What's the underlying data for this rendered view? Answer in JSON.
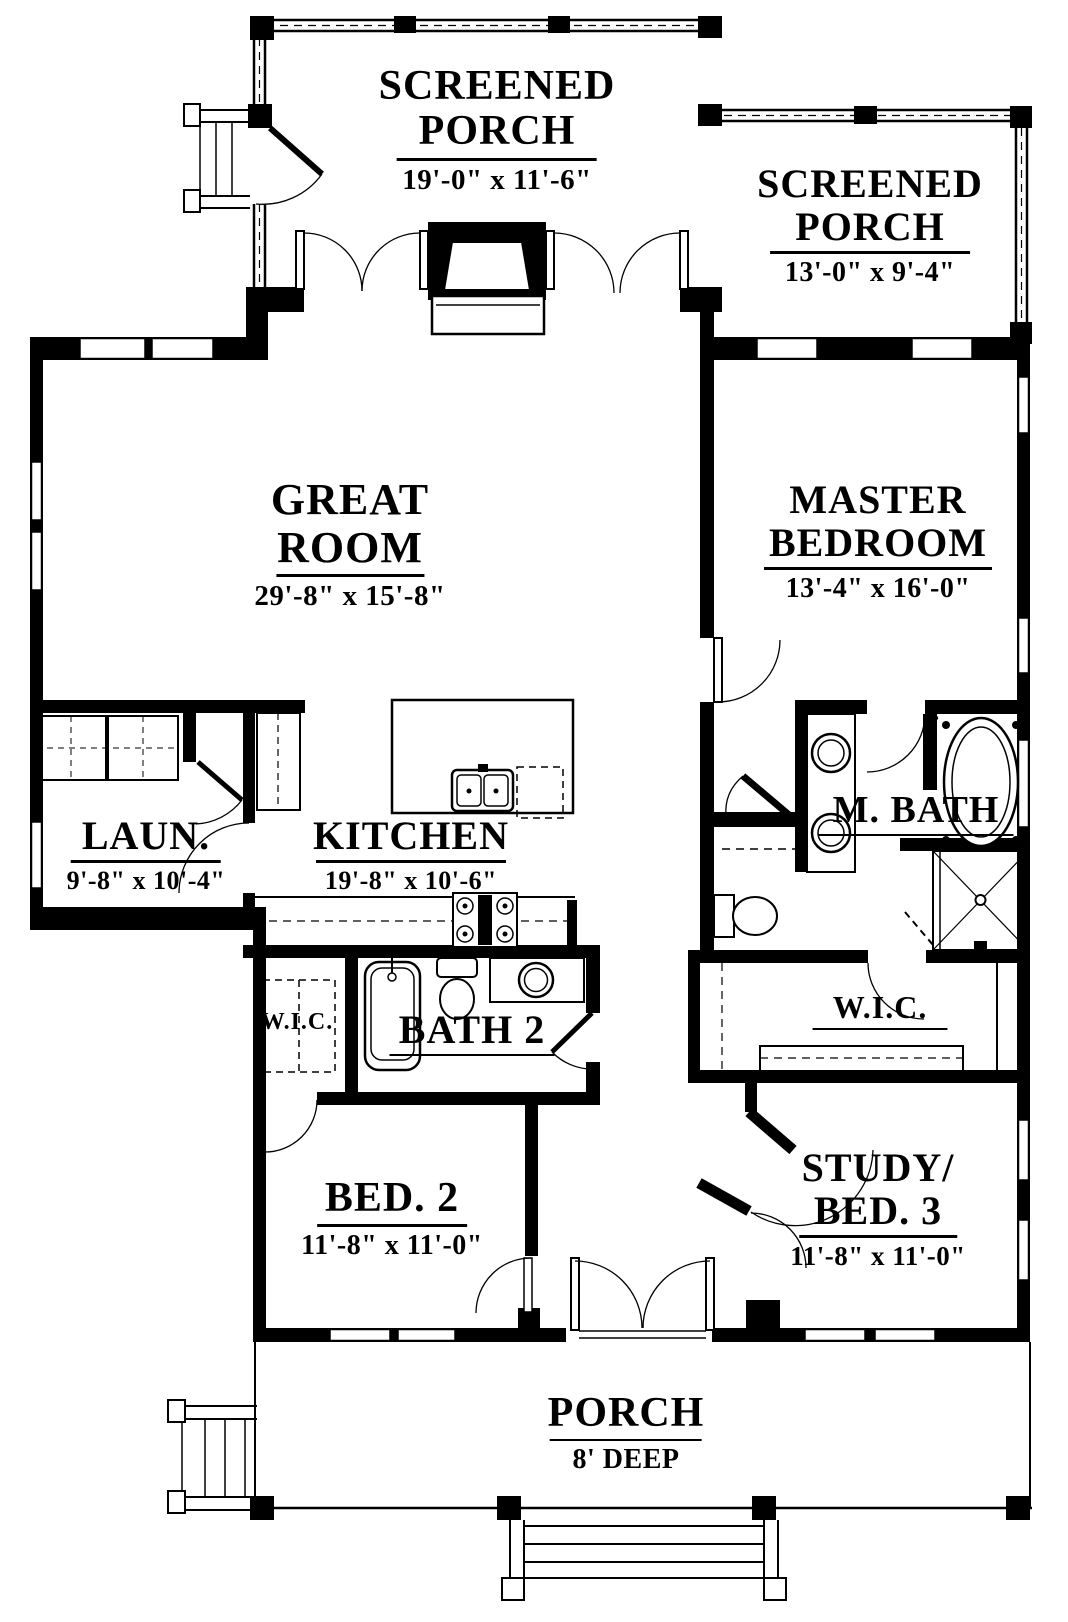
{
  "plan": {
    "type": "house floor plan",
    "colors": {
      "wall": "#000000",
      "paper": "#ffffff"
    }
  },
  "rooms": {
    "screened_porch_left": {
      "name_line1": "SCREENED",
      "name_line2": "PORCH",
      "dims": "19'-0\" x 11'-6\""
    },
    "screened_porch_right": {
      "name_line1": "SCREENED",
      "name_line2": "PORCH",
      "dims": "13'-0\" x 9'-4\""
    },
    "great_room": {
      "name_line1": "GREAT",
      "name_line2": "ROOM",
      "dims": "29'-8\" x 15'-8\""
    },
    "master_bedroom": {
      "name_line1": "MASTER",
      "name_line2": "BEDROOM",
      "dims": "13'-4\" x 16'-0\""
    },
    "laundry": {
      "name": "LAUN.",
      "dims": "9'-8\" x 10'-4\""
    },
    "kitchen": {
      "name": "KITCHEN",
      "dims": "19'-8\" x 10'-6\""
    },
    "master_bath": {
      "name": "M. BATH"
    },
    "wic_left": {
      "name": "W.I.C."
    },
    "bath_2": {
      "name": "BATH 2"
    },
    "wic_right": {
      "name": "W.I.C."
    },
    "bed_2": {
      "name": "BED. 2",
      "dims": "11'-8\" x 11'-0\""
    },
    "study_bed_3": {
      "name_line1": "STUDY/",
      "name_line2": "BED. 3",
      "dims": "11'-8\" x 11'-0\""
    },
    "porch": {
      "name": "PORCH",
      "dims": "8' DEEP"
    }
  }
}
